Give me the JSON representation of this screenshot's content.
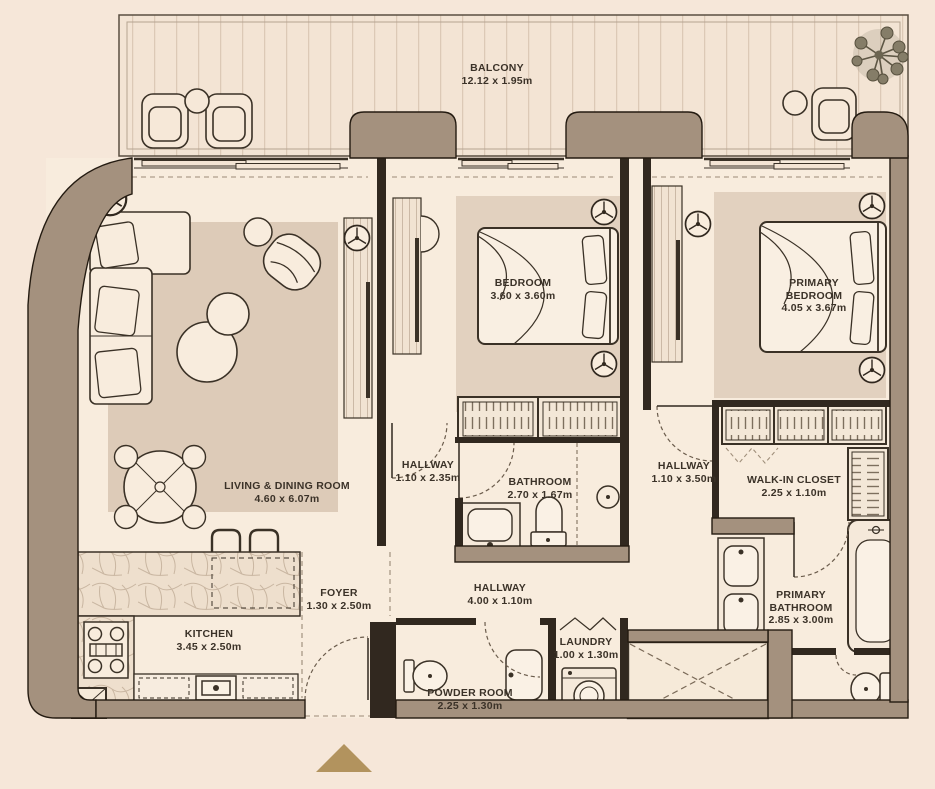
{
  "plan": {
    "balcony": {
      "name": "BALCONY",
      "dims": "12.12 x 1.95m"
    },
    "rooms": [
      {
        "key": "living",
        "name": "LIVING & DINING ROOM",
        "dims": "4.60 x 6.07m"
      },
      {
        "key": "kitchen",
        "name": "KITCHEN",
        "dims": "3.45 x 2.50m"
      },
      {
        "key": "foyer",
        "name": "FOYER",
        "dims": "1.30 x 2.50m"
      },
      {
        "key": "bedroom",
        "name": "BEDROOM",
        "dims": "3.60 x 3.60m"
      },
      {
        "key": "primary_bedroom",
        "name": "PRIMARY BEDROOM",
        "dims": "4.05 x 3.67m"
      },
      {
        "key": "hallway_bedroom",
        "name": "HALLWAY",
        "dims": "1.10 x 2.35m"
      },
      {
        "key": "bathroom",
        "name": "BATHROOM",
        "dims": "2.70 x 1.67m"
      },
      {
        "key": "hallway_primary",
        "name": "HALLWAY",
        "dims": "1.10 x 3.50m"
      },
      {
        "key": "walk_in_closet",
        "name": "WALK-IN CLOSET",
        "dims": "2.25 x 1.10m"
      },
      {
        "key": "hallway_main",
        "name": "HALLWAY",
        "dims": "4.00 x 1.10m"
      },
      {
        "key": "powder_room",
        "name": "POWDER ROOM",
        "dims": "2.25 x 1.30m"
      },
      {
        "key": "laundry",
        "name": "LAUNDRY",
        "dims": "1.00 x 1.30m"
      },
      {
        "key": "primary_bathroom",
        "name": "PRIMARY BATHROOM",
        "dims": "2.85 x 3.00m"
      }
    ],
    "colors": {
      "background": "#f6e7d9",
      "exterior_wall": "#a4917e",
      "interior_wall": "#31281f",
      "floor": "#f8ecdd",
      "rug": "#ddcbb8",
      "entrance_arrow": "#b2935e"
    },
    "icons": [
      "tree-icon",
      "entrance-arrow-icon",
      "ceiling-fixture-icon"
    ]
  }
}
